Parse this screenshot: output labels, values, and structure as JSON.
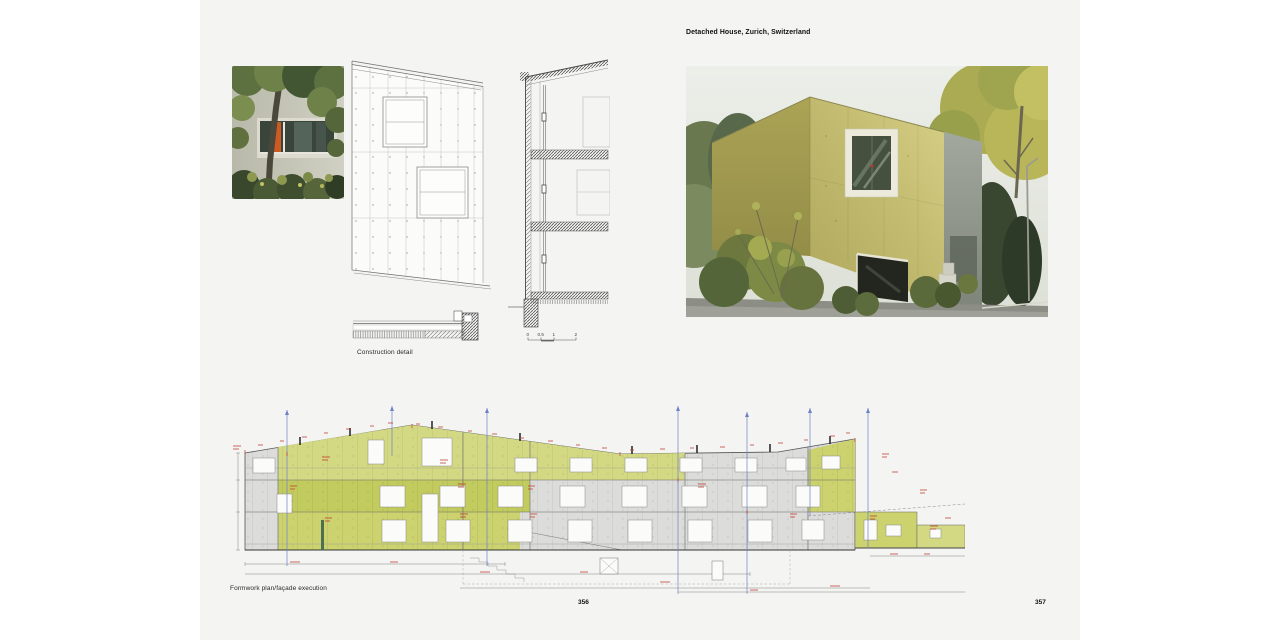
{
  "book": {
    "title": "Detached House, Zurich, Switzerland",
    "left_page": {
      "captions": {
        "construction_detail": "Construction detail",
        "formwork_plan": "Formwork plan/façade execution"
      },
      "page_number": "356",
      "scale_bar_labels": [
        "0",
        "0.5",
        "1",
        "2"
      ]
    },
    "right_page": {
      "page_number": "357"
    },
    "photos": {
      "small_photo": "tree and shrubs in front of concrete facade with window band and orange door",
      "large_photo": "yellow-green faceted concrete house with large square window, garage band, autumn trees"
    },
    "drawings": {
      "construction_detail": "facade fragment elevation, vertical wall section, horizontal plan detail",
      "formwork_plan": "long facade elevation with green highlighted formwork stages, red dimensions, blue axes"
    },
    "colors": {
      "page_background": "#f4f4f3",
      "canvas_background": "#ffffff",
      "formwork_green": "#cbd26e",
      "formwork_green_light": "#d3d982",
      "formwork_green_dark": "#c2cb5e",
      "annotation_red": "#c0392b",
      "axis_blue": "#7080c8",
      "facade_yellow": "#c1ba6c",
      "drawing_gray": "#dcdcda"
    }
  }
}
